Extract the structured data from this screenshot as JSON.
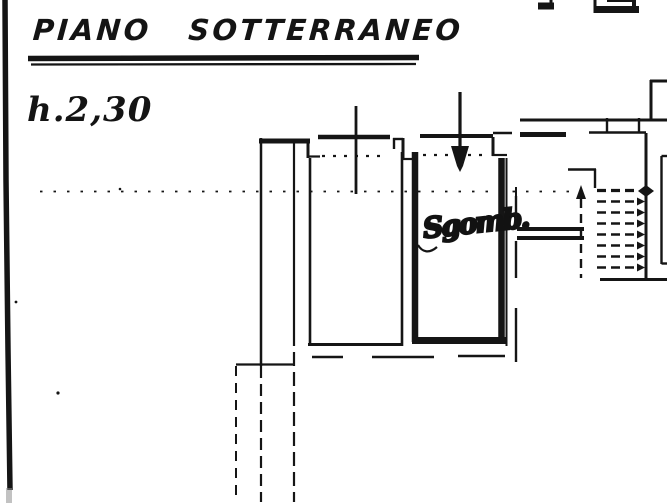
{
  "colors": {
    "background": "#ffffff",
    "ink": "#151515"
  },
  "title": {
    "text": "PIANO SOTTERRANEO"
  },
  "annotations": {
    "height_note": "h.2,30",
    "storage_room_label": "Sgomb."
  },
  "icons": {
    "entrance_arrow_icon": "down-arrow",
    "stair_direction_arrow_icon": "up-arrow",
    "section_marker_icon": "diamond"
  }
}
